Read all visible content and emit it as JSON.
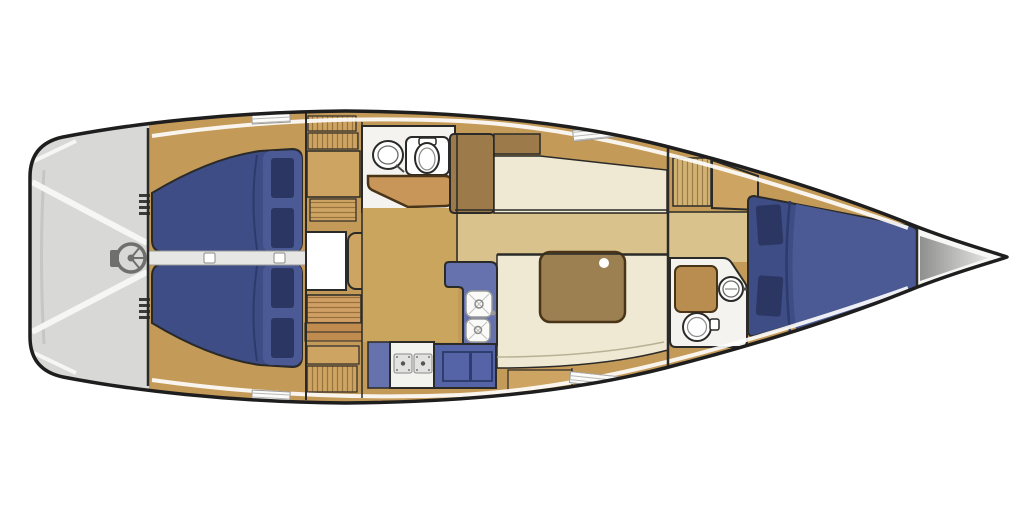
{
  "meta": {
    "title": "Sailboat interior floor plan (plan view, bow to the right)",
    "rooms": [
      "cockpit",
      "aft-cabin-port",
      "aft-cabin-starboard",
      "companionway",
      "aft-head",
      "nav-station",
      "saloon",
      "galley",
      "dinette",
      "forward-head",
      "forward-cabin-v-berth",
      "anchor-locker"
    ]
  },
  "colors": {
    "hull_outline": "#1e1e1e",
    "line_dark": "#2a2a28",
    "cockpit": "#d8d8d6",
    "cockpit_stripe": "#f6f6f4",
    "wheel_gray": "#6f6f6d",
    "corridor": "#e6e6e4",
    "handle_white": "#ffffff",
    "deck_teak": "#c49a58",
    "locker_tan": "#cda462",
    "ladder_tan": "#cf9f63",
    "step_tan": "#c08b4e",
    "wood_brown": "#9c7a4a",
    "counter_brown": "#b98d50",
    "berth_navy": "#3e4d86",
    "berth_navy_light": "#4b5a94",
    "pillow_navy": "#2b3663",
    "seam_navy": "#2e3a6b",
    "head_white": "#f4f3ef",
    "fixture_white": "#ffffff",
    "nav_table": "#c9965a",
    "saloon_floor": "#c9a55e",
    "floor_khaki": "#dac28c",
    "settee_cream": "#efe8d3",
    "table_brown": "#9d8052",
    "table_dot": "#ffffff",
    "galley_blue": "#6572ad",
    "cabinet_blue": "#5564a6",
    "door_outline": "#2f3c6e",
    "stove_white": "#f2f2ee",
    "burner_gray": "#e2e2e0",
    "burner_dot": "#555553",
    "sink_white": "#fafaf8",
    "bow_white": "#f7f7f5",
    "bow_gray": "#9c9c9a",
    "hatch_white": "#fbfbf9",
    "deck_stripe": "#ffffff"
  }
}
